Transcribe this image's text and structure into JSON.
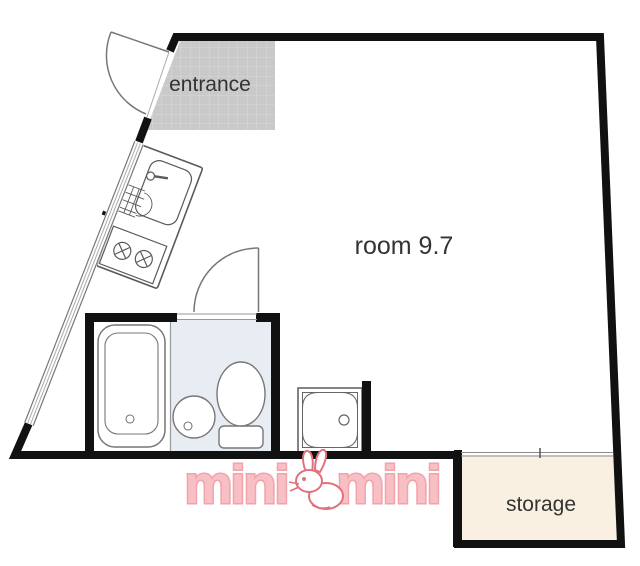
{
  "plan": {
    "labels": {
      "entrance": "entrance",
      "room": "room 9.7",
      "storage": "storage"
    },
    "watermark": {
      "text_left": "mini",
      "text_right": "mini",
      "mascot": "rabbit"
    },
    "colors": {
      "wall": "#111111",
      "entrance_tile": "#c9c9c9",
      "tile_grid": "#d9d9d9",
      "bathroom_floor": "#e8edf3",
      "storage_fill": "#faf0e2",
      "fixture_line": "#5a5a5a",
      "thin_line": "#999999",
      "label_text": "#333333",
      "logo_fill": "#f8c0c4",
      "logo_stroke": "#f0a3a9",
      "mascot_line": "#e2717d"
    }
  }
}
